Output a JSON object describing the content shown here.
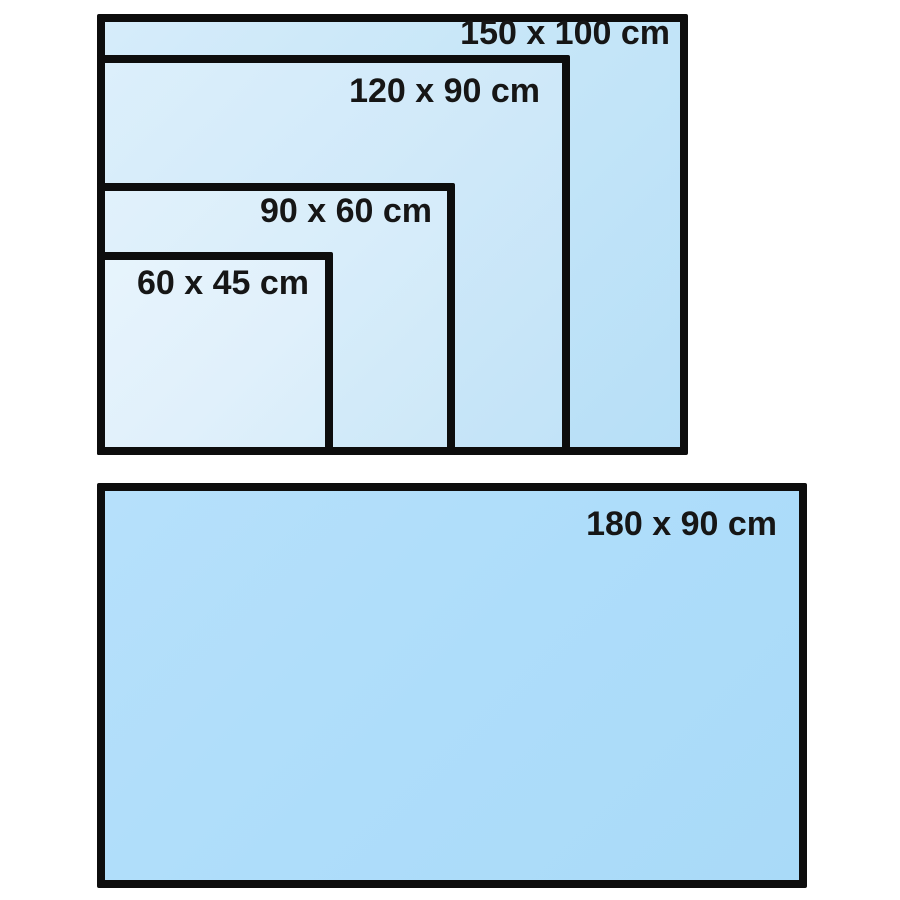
{
  "colors": {
    "background": "#ffffff",
    "rect_border": "#0d0d0d",
    "label_text": "#161616",
    "fill_innermost": "#e7f4fc",
    "fill_outermost": "#b7dff7",
    "fill_bottom_rect": "#aeddfa"
  },
  "top_group": {
    "sizes": [
      {
        "label": "150 x 100 cm",
        "width_cm": 150,
        "height_cm": 100
      },
      {
        "label": "120 x 90 cm",
        "width_cm": 120,
        "height_cm": 90
      },
      {
        "label": "90 x 60 cm",
        "width_cm": 90,
        "height_cm": 60
      },
      {
        "label": "60 x 45 cm",
        "width_cm": 60,
        "height_cm": 45
      }
    ]
  },
  "bottom_group": {
    "sizes": [
      {
        "label": "180 x 90 cm",
        "width_cm": 180,
        "height_cm": 90
      }
    ]
  }
}
